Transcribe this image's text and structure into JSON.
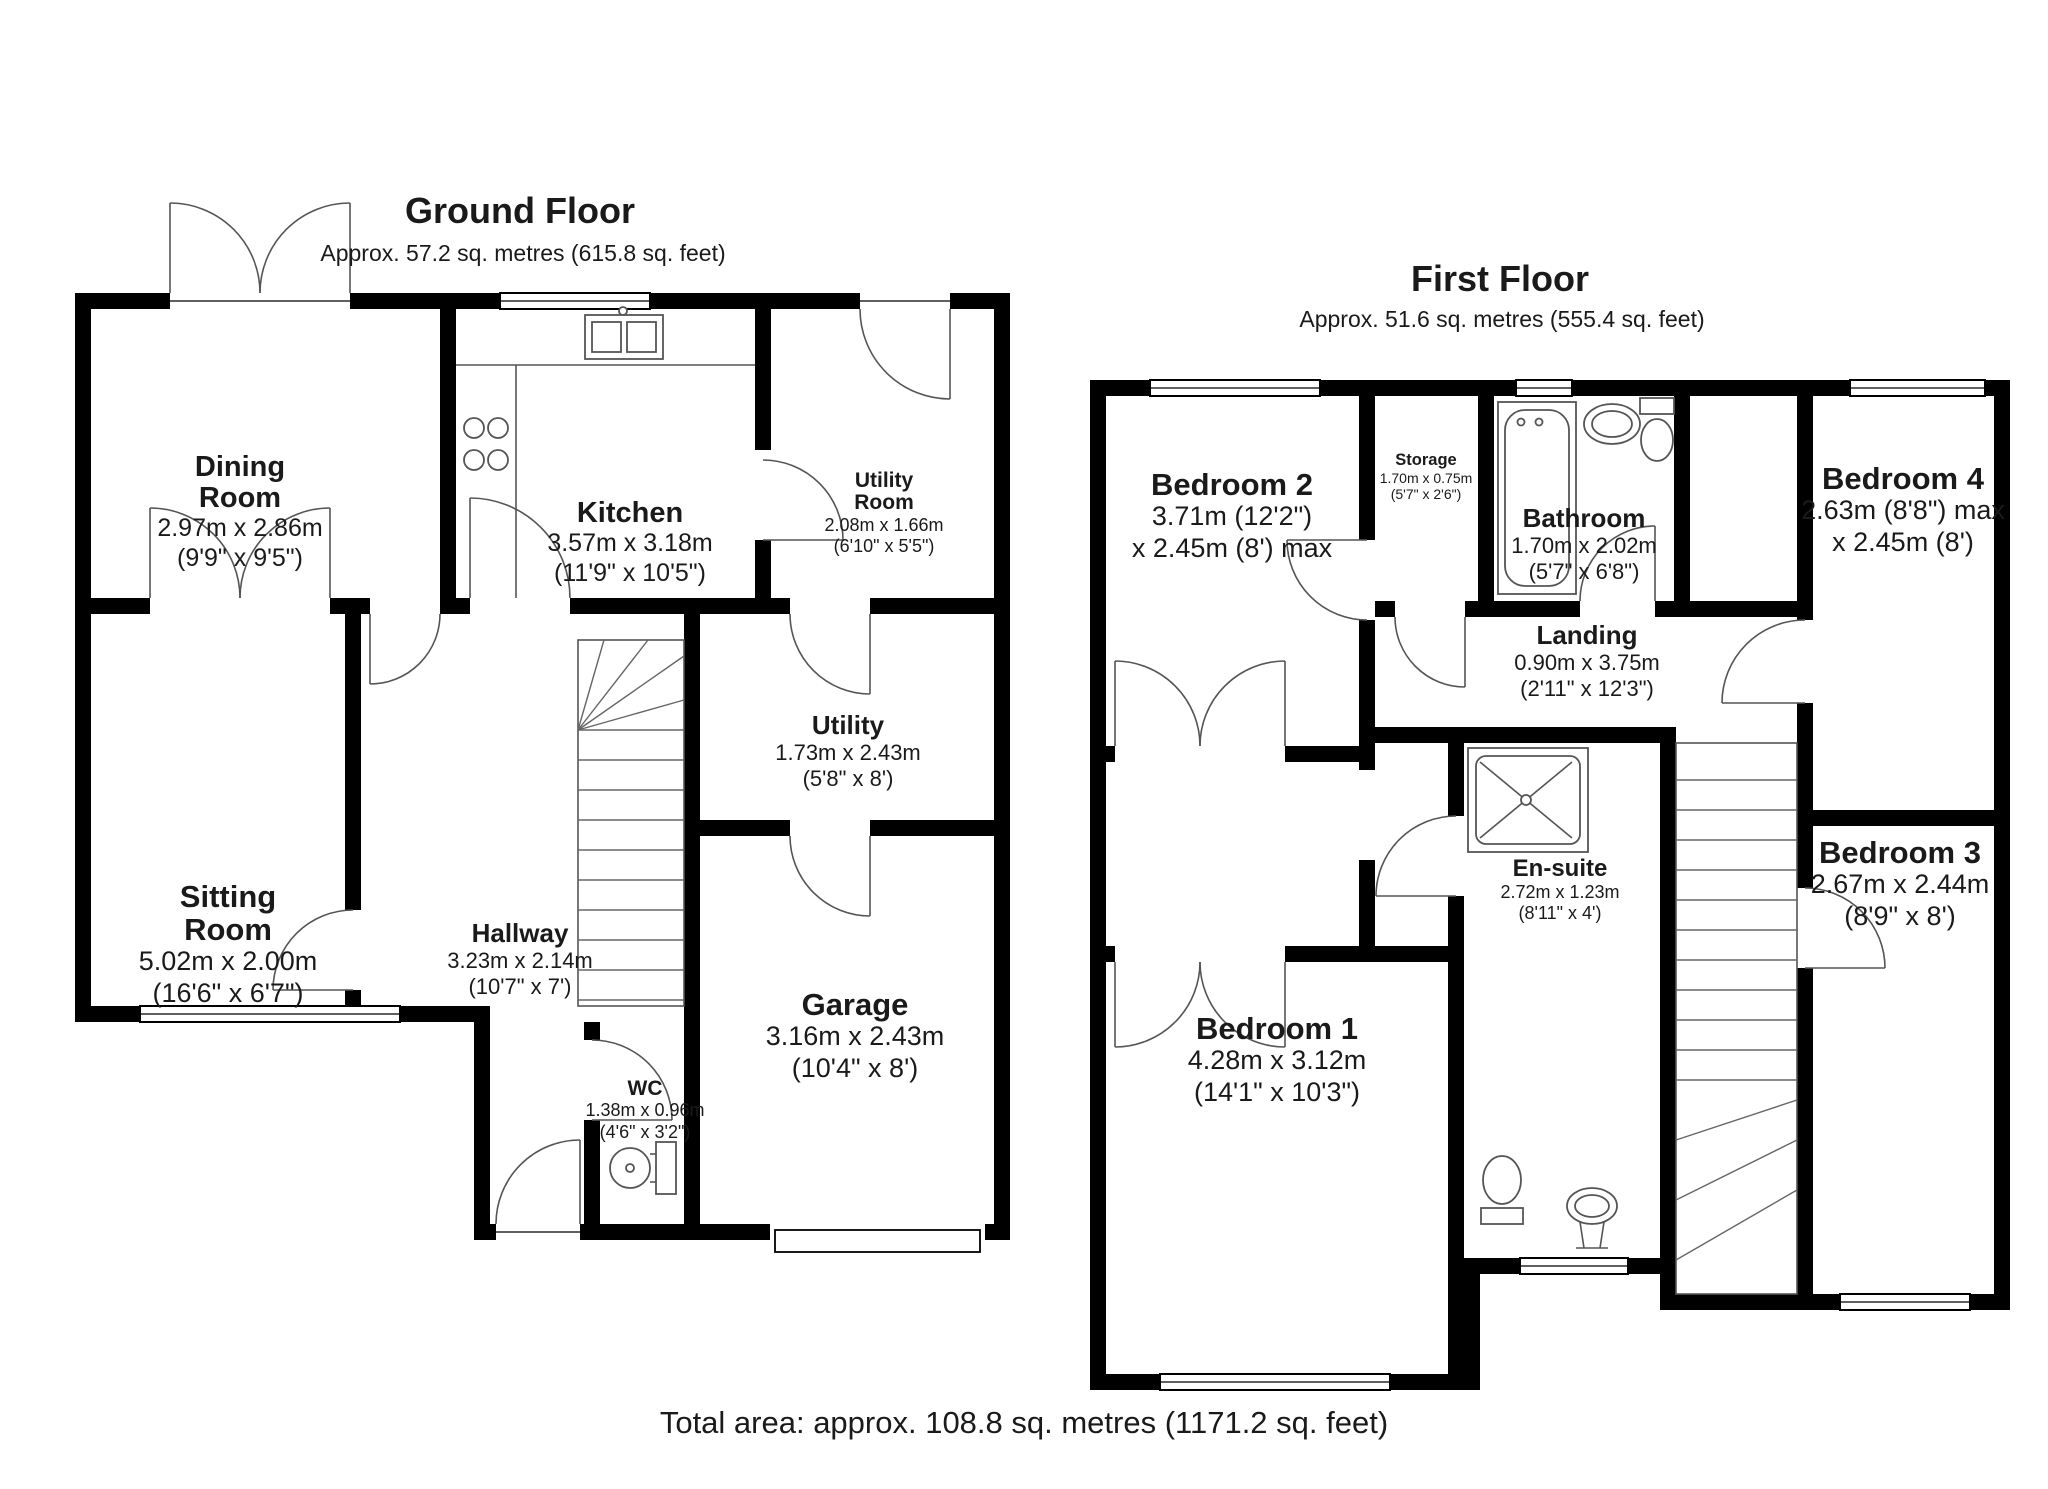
{
  "ground": {
    "title": "Ground Floor",
    "subtitle": "Approx. 57.2 sq. metres (615.8 sq. feet)",
    "rooms": [
      {
        "lines": [
          "Dining",
          "Room"
        ],
        "size_m": "2.97m x 2.86m",
        "size_ft": "(9'9\" x 9'5\")"
      },
      {
        "lines": [
          "Kitchen"
        ],
        "size_m": "3.57m x 3.18m",
        "size_ft": "(11'9\" x 10'5\")"
      },
      {
        "lines": [
          "Utility",
          "Room"
        ],
        "size_m": "2.08m x 1.66m",
        "size_ft": "(6'10\" x 5'5\")"
      },
      {
        "lines": [
          "Utility"
        ],
        "size_m": "1.73m x 2.43m",
        "size_ft": "(5'8\" x 8')"
      },
      {
        "lines": [
          "Sitting",
          "Room"
        ],
        "size_m": "5.02m x 2.00m",
        "size_ft": "(16'6\" x 6'7\")"
      },
      {
        "lines": [
          "Hallway"
        ],
        "size_m": "3.23m x 2.14m",
        "size_ft": "(10'7\" x 7')"
      },
      {
        "lines": [
          "Garage"
        ],
        "size_m": "3.16m x 2.43m",
        "size_ft": "(10'4\" x 8')"
      },
      {
        "lines": [
          "WC"
        ],
        "size_m": "1.38m x 0.96m",
        "size_ft": "(4'6\" x 3'2\")"
      }
    ]
  },
  "first": {
    "title": "First Floor",
    "subtitle": "Approx. 51.6 sq. metres (555.4 sq. feet)",
    "rooms": [
      {
        "lines": [
          "Bedroom 2"
        ],
        "size_m": "3.71m (12'2\")",
        "size_ft": "x 2.45m (8') max"
      },
      {
        "lines": [
          "Storage"
        ],
        "size_m": "1.70m x 0.75m",
        "size_ft": "(5'7\" x 2'6\")"
      },
      {
        "lines": [
          "Bathroom"
        ],
        "size_m": "1.70m x 2.02m",
        "size_ft": "(5'7\" x 6'8\")"
      },
      {
        "lines": [
          "Bedroom 4"
        ],
        "size_m": "2.63m (8'8\") max",
        "size_ft": "x 2.45m (8')"
      },
      {
        "lines": [
          "Landing"
        ],
        "size_m": "0.90m x 3.75m",
        "size_ft": "(2'11\" x 12'3\")"
      },
      {
        "lines": [
          "En-suite"
        ],
        "size_m": "2.72m x 1.23m",
        "size_ft": "(8'11\" x 4')"
      },
      {
        "lines": [
          "Bedroom 3"
        ],
        "size_m": "2.67m x 2.44m",
        "size_ft": "(8'9\" x 8')"
      },
      {
        "lines": [
          "Bedroom 1"
        ],
        "size_m": "4.28m x 3.12m",
        "size_ft": "(14'1\" x 10'3\")"
      }
    ]
  },
  "footer": {
    "total_area": "Total area: approx. 108.8 sq. metres (1171.2 sq. feet)"
  },
  "colors": {
    "wall": "#000000",
    "line": "#555555",
    "text": "#1a1a1a",
    "background": "#ffffff"
  }
}
